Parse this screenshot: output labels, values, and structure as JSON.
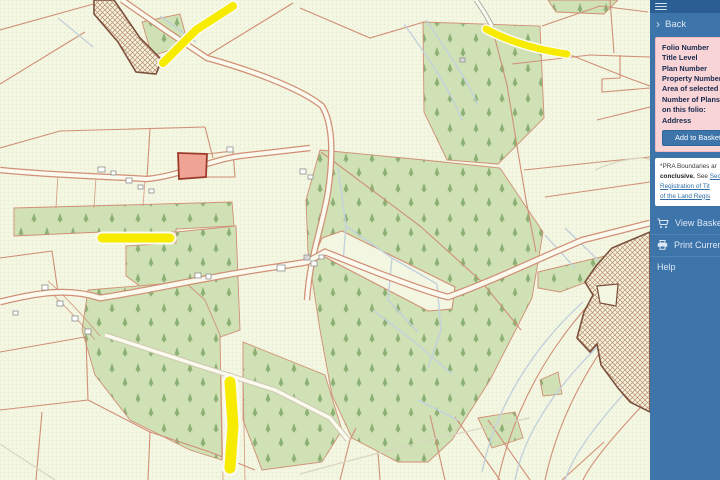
{
  "sidebar": {
    "back_label": "Back",
    "folio_panel": {
      "labels": [
        "Folio Number",
        "Title Level",
        "Plan Number",
        "Property Number",
        "Area of selected pla",
        "Number of Plans on this folio:",
        "Address"
      ],
      "add_button": "Add to Basket"
    },
    "disclaimer": {
      "line1": "*PRA Boundaries ar",
      "bold": "conclusive.",
      "mid": " See ",
      "link1": "Sec",
      "link2": "Registration of Tit",
      "link3": "of the Land Regis"
    },
    "items": [
      {
        "label": "View Basket",
        "icon": "cart-icon"
      },
      {
        "label": "Print Current V",
        "icon": "printer-icon"
      },
      {
        "label": "Help",
        "icon": ""
      }
    ]
  },
  "map": {
    "legend": {
      "forest": "coniferous forestry parcels",
      "yellow": "classified road segments",
      "hatched": "cross-hatched pending-application areas",
      "highlight": "selected parcel"
    }
  },
  "colors": {
    "map-bg": "#f3f6e1",
    "map-dot": "#e3e8cc",
    "boundary": "#d08f76",
    "water": "#c3d1dd",
    "forest-bg": "#cfe1b5",
    "tree": "#8caf74",
    "road-fill": "#fbfaee",
    "road-yellow": "#f7ec00",
    "hatch-line": "#b48e6a",
    "hatch-bg": "#f7f3e1",
    "hatch-border": "#7c4f3c",
    "highlight-fill": "#f0a495",
    "highlight-border": "#9c3d2c",
    "sb-top": "#2b5f94",
    "sb-bg": "#3d74aa",
    "panel-pink": "#f9d4d6"
  }
}
